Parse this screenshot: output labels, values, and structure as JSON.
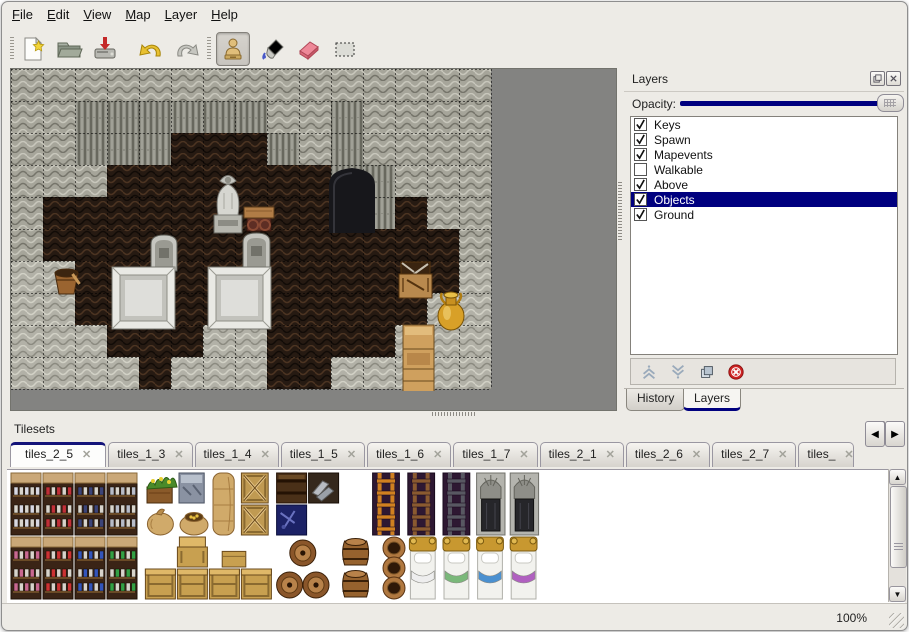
{
  "window": {
    "accent": "#00007f",
    "background": "#edebe6"
  },
  "menu": {
    "items": [
      {
        "label": "File"
      },
      {
        "label": "Edit"
      },
      {
        "label": "View"
      },
      {
        "label": "Map"
      },
      {
        "label": "Layer"
      },
      {
        "label": "Help"
      }
    ]
  },
  "toolbar": {
    "buttons": [
      {
        "name": "new",
        "icon": "new-document-icon"
      },
      {
        "name": "open",
        "icon": "open-folder-icon"
      },
      {
        "name": "save",
        "icon": "save-icon"
      },
      {
        "name": "undo",
        "icon": "undo-arrow-icon"
      },
      {
        "name": "redo",
        "icon": "redo-arrow-icon"
      }
    ],
    "tools": [
      {
        "name": "stamp",
        "icon": "stamp-tool-icon",
        "active": true
      },
      {
        "name": "fill",
        "icon": "fill-bucket-icon",
        "active": false
      },
      {
        "name": "eraser",
        "icon": "eraser-icon",
        "active": false
      },
      {
        "name": "select",
        "icon": "rect-select-icon",
        "active": false
      }
    ]
  },
  "layers_panel": {
    "title": "Layers",
    "opacity_label": "Opacity:",
    "opacity_value": 100,
    "layers": [
      {
        "label": "Keys",
        "checked": true,
        "selected": false
      },
      {
        "label": "Spawn",
        "checked": true,
        "selected": false
      },
      {
        "label": "Mapevents",
        "checked": true,
        "selected": false
      },
      {
        "label": "Walkable",
        "checked": false,
        "selected": false
      },
      {
        "label": "Above",
        "checked": true,
        "selected": false
      },
      {
        "label": "Objects",
        "checked": true,
        "selected": true
      },
      {
        "label": "Ground",
        "checked": true,
        "selected": false
      }
    ],
    "buttons": [
      {
        "name": "move-layer-up",
        "icon": "chevron-up-icon"
      },
      {
        "name": "move-layer-down",
        "icon": "chevron-down-icon"
      },
      {
        "name": "duplicate-layer",
        "icon": "duplicate-icon"
      },
      {
        "name": "delete-layer",
        "icon": "delete-icon"
      }
    ],
    "tabs": [
      {
        "label": "History",
        "active": false
      },
      {
        "label": "Layers",
        "active": true
      }
    ]
  },
  "tilesets_panel": {
    "title": "Tilesets",
    "tabs": [
      {
        "label": "tiles_2_5",
        "active": true,
        "clipped": false
      },
      {
        "label": "tiles_1_3",
        "active": false,
        "clipped": false
      },
      {
        "label": "tiles_1_4",
        "active": false,
        "clipped": false
      },
      {
        "label": "tiles_1_5",
        "active": false,
        "clipped": false
      },
      {
        "label": "tiles_1_6",
        "active": false,
        "clipped": false
      },
      {
        "label": "tiles_1_7",
        "active": false,
        "clipped": false
      },
      {
        "label": "tiles_2_1",
        "active": false,
        "clipped": false
      },
      {
        "label": "tiles_2_6",
        "active": false,
        "clipped": false
      },
      {
        "label": "tiles_2_7",
        "active": false,
        "clipped": false
      },
      {
        "label": "tiles_",
        "active": false,
        "clipped": true
      }
    ]
  },
  "statusbar": {
    "zoom": "100%"
  },
  "map": {
    "tile_size": 32,
    "grid": [
      "WWWWWWWWWWWWWWW",
      "WWCCCCCCWWDWWWW",
      "WWCCCFFFCWDWWWW",
      "WWWFFFFFFFCCWWW",
      "WFFFFFFFFFFCFWW",
      "WFFFFFFFFFFFFFW",
      "GGFFFFFFFFFFFFG",
      "GGFFFFFFFFFFFGG",
      "GGGFFFGGFFFFGGG",
      "GGGGFGGGFFGGGGG"
    ],
    "objects": [
      {
        "type": "doorway",
        "x": 318,
        "y": 96,
        "w": 46,
        "h": 68
      },
      {
        "type": "statue",
        "x": 202,
        "y": 100,
        "w": 30,
        "h": 64
      },
      {
        "type": "table",
        "x": 233,
        "y": 134,
        "w": 30,
        "h": 30
      },
      {
        "type": "tombstone",
        "x": 140,
        "y": 166,
        "w": 26,
        "h": 36
      },
      {
        "type": "tombstone",
        "x": 232,
        "y": 164,
        "w": 27,
        "h": 40
      },
      {
        "type": "tomb",
        "x": 101,
        "y": 198,
        "w": 63,
        "h": 62
      },
      {
        "type": "tomb",
        "x": 197,
        "y": 198,
        "w": 63,
        "h": 62
      },
      {
        "type": "bucket",
        "x": 41,
        "y": 197,
        "w": 29,
        "h": 29
      },
      {
        "type": "cratestack",
        "x": 388,
        "y": 191,
        "w": 33,
        "h": 38
      },
      {
        "type": "goldjug",
        "x": 425,
        "y": 223,
        "w": 30,
        "h": 39
      },
      {
        "type": "cabinet",
        "x": 392,
        "y": 256,
        "w": 31,
        "h": 68
      },
      {
        "type": "barrel",
        "x": 295,
        "y": 327,
        "w": 29,
        "h": 32
      }
    ]
  },
  "tileset_tiles": [
    {
      "t": "shelf",
      "c": 0,
      "r": 0,
      "w": 1,
      "h": 2,
      "a": "#d8d8e2"
    },
    {
      "t": "shelf",
      "c": 1,
      "r": 0,
      "w": 1,
      "h": 2,
      "a": "#c03038"
    },
    {
      "t": "shelf",
      "c": 2,
      "r": 0,
      "w": 1,
      "h": 2,
      "a": "#3c4478"
    },
    {
      "t": "shelf",
      "c": 3,
      "r": 0,
      "w": 1,
      "h": 2,
      "a": "#b8bcc8"
    },
    {
      "t": "shelf",
      "c": 0,
      "r": 2,
      "w": 1,
      "h": 2,
      "a": "#c86890"
    },
    {
      "t": "shelf",
      "c": 1,
      "r": 2,
      "w": 1,
      "h": 2,
      "a": "#cc3333"
    },
    {
      "t": "shelf",
      "c": 2,
      "r": 2,
      "w": 1,
      "h": 2,
      "a": "#3355bb"
    },
    {
      "t": "shelf",
      "c": 3,
      "r": 2,
      "w": 1,
      "h": 2,
      "a": "#33a044"
    },
    {
      "t": "planter",
      "c": 4.25,
      "r": 0,
      "w": 0.85,
      "h": 1
    },
    {
      "t": "stonebox",
      "c": 5.25,
      "r": 0,
      "w": 0.85,
      "h": 1
    },
    {
      "t": "sacktall",
      "c": 6.25,
      "r": 0,
      "w": 0.85,
      "h": 2
    },
    {
      "t": "cratex",
      "c": 7.2,
      "r": 0,
      "w": 0.9,
      "h": 1
    },
    {
      "t": "cratex",
      "c": 7.2,
      "r": 1,
      "w": 0.9,
      "h": 1
    },
    {
      "t": "sack",
      "c": 4.2,
      "r": 1,
      "w": 1,
      "h": 1
    },
    {
      "t": "sackopen",
      "c": 5.25,
      "r": 1,
      "w": 1,
      "h": 1
    },
    {
      "t": "darkchest",
      "c": 8.3,
      "r": 0,
      "w": 1,
      "h": 1
    },
    {
      "t": "metalpile",
      "c": 9.3,
      "r": 0,
      "w": 1,
      "h": 1
    },
    {
      "t": "navybox",
      "c": 8.3,
      "r": 1,
      "w": 1,
      "h": 1
    },
    {
      "t": "ladder",
      "c": 11.3,
      "r": 0,
      "w": 0.9,
      "h": 2,
      "a": "#d08020"
    },
    {
      "t": "ladder",
      "c": 12.4,
      "r": 0,
      "w": 0.9,
      "h": 2,
      "a": "#8a5a30"
    },
    {
      "t": "ladder",
      "c": 13.5,
      "r": 0,
      "w": 0.9,
      "h": 2,
      "a": "#585862"
    },
    {
      "t": "doorstone",
      "c": 14.55,
      "r": 0,
      "w": 0.95,
      "h": 2
    },
    {
      "t": "doorstone",
      "c": 15.6,
      "r": 0,
      "w": 0.95,
      "h": 2
    },
    {
      "t": "cratelid",
      "c": 5.2,
      "r": 2,
      "w": 1,
      "h": 1
    },
    {
      "t": "cratesmall",
      "c": 6.6,
      "r": 2.45,
      "w": 0.8,
      "h": 0.55
    },
    {
      "t": "crate",
      "c": 4.2,
      "r": 3,
      "w": 1,
      "h": 1
    },
    {
      "t": "crate",
      "c": 5.2,
      "r": 3,
      "w": 1,
      "h": 1
    },
    {
      "t": "crate",
      "c": 6.2,
      "r": 3,
      "w": 1,
      "h": 1
    },
    {
      "t": "crate",
      "c": 7.2,
      "r": 3,
      "w": 1,
      "h": 1
    },
    {
      "t": "barrelpile",
      "c": 8.3,
      "r": 2,
      "w": 1.7,
      "h": 2
    },
    {
      "t": "barrelside",
      "c": 10.3,
      "r": 2,
      "w": 1,
      "h": 1
    },
    {
      "t": "barrelside",
      "c": 10.3,
      "r": 3,
      "w": 1,
      "h": 1
    },
    {
      "t": "pots",
      "c": 11.5,
      "r": 2,
      "w": 1,
      "h": 2
    },
    {
      "t": "bed",
      "c": 12.45,
      "r": 2,
      "w": 0.9,
      "h": 2,
      "a": "#eeeeee"
    },
    {
      "t": "bed",
      "c": 13.5,
      "r": 2,
      "w": 0.9,
      "h": 2,
      "a": "#7ab87a"
    },
    {
      "t": "bed",
      "c": 14.55,
      "r": 2,
      "w": 0.9,
      "h": 2,
      "a": "#4a90d0"
    },
    {
      "t": "bed",
      "c": 15.6,
      "r": 2,
      "w": 0.9,
      "h": 2,
      "a": "#b060c0"
    }
  ]
}
